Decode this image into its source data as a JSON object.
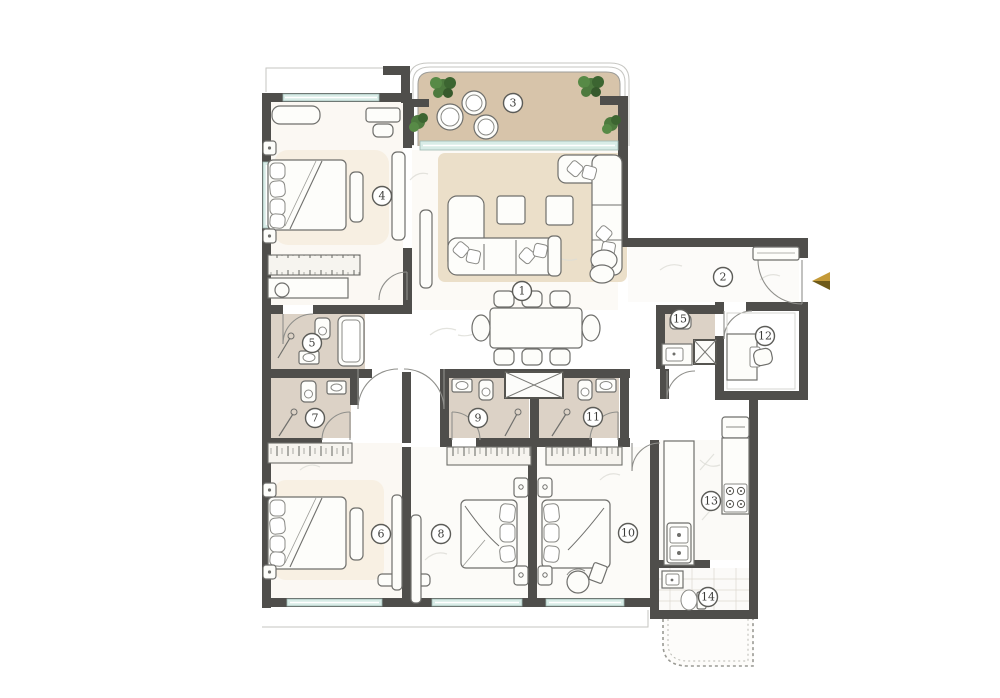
{
  "plan": {
    "type": "apartment-floor-plan",
    "room_labels": [
      {
        "number": "1",
        "transform": "translate(522,291)"
      },
      {
        "number": "2",
        "transform": "translate(723,277)"
      },
      {
        "number": "3",
        "transform": "translate(513,103)"
      },
      {
        "number": "4",
        "transform": "translate(382,196)"
      },
      {
        "number": "5",
        "transform": "translate(312,343)"
      },
      {
        "number": "6",
        "transform": "translate(381,534)"
      },
      {
        "number": "7",
        "transform": "translate(315,418)"
      },
      {
        "number": "8",
        "transform": "translate(441,534)"
      },
      {
        "number": "9",
        "transform": "translate(478,418)"
      },
      {
        "number": "10",
        "transform": "translate(628,533)"
      },
      {
        "number": "11",
        "transform": "translate(593,417)"
      },
      {
        "number": "12",
        "transform": "translate(765,336)"
      },
      {
        "number": "13",
        "transform": "translate(711,501)"
      },
      {
        "number": "14",
        "transform": "translate(708,597)"
      },
      {
        "number": "15",
        "transform": "translate(680,319)"
      }
    ],
    "entry_arrow": {
      "points_top": "830,272 812,281 830,281",
      "points_bottom": "830,281 812,281 830,290",
      "color_top": "#c49a38",
      "color_bottom": "#6e5a19"
    },
    "colors": {
      "wall": "#4f4e4b",
      "window": "#d8ece7",
      "balcony_floor": "#d7c4aa",
      "rug": "#ebdfc9",
      "bathroom_floor": "#dcd2c6",
      "plant": "#4d7a3e",
      "accent_gold": "#c49a38"
    }
  }
}
